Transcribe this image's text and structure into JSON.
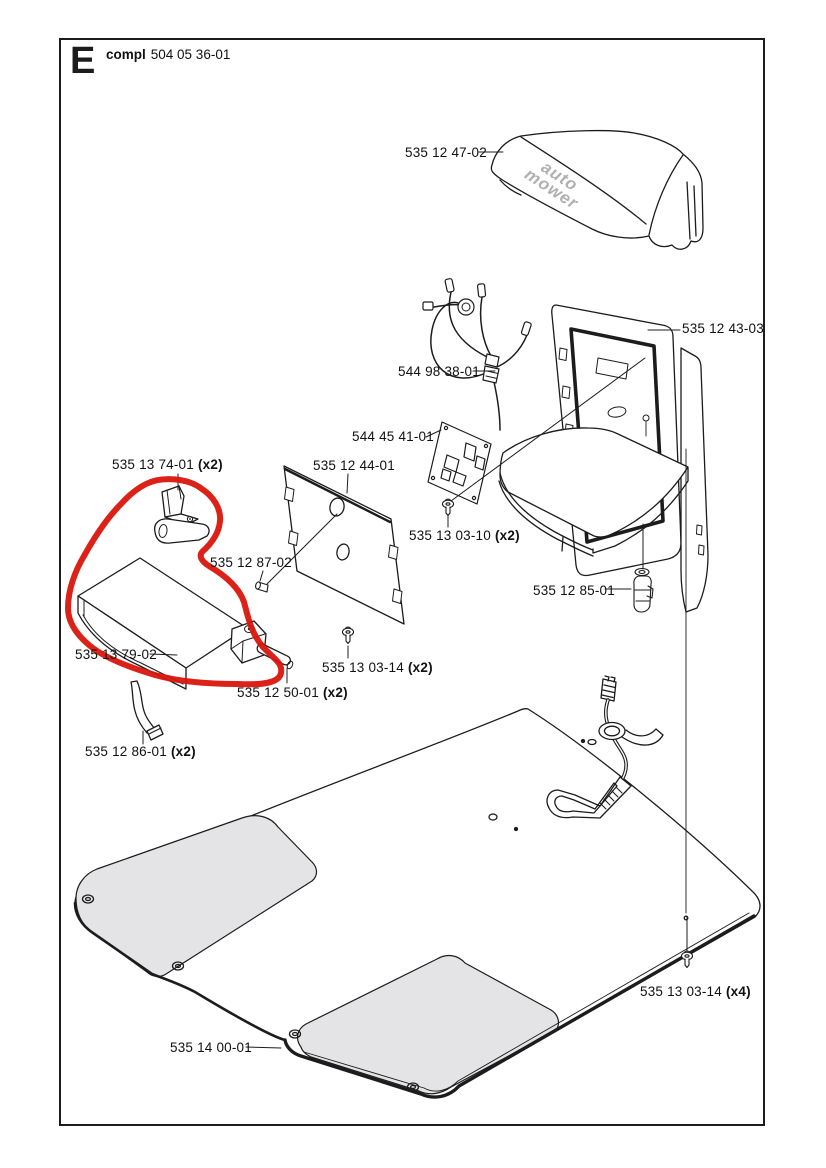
{
  "header": {
    "letter": "E",
    "compl_label": "compl",
    "assembly_number": "504 05 36-01"
  },
  "logo": {
    "line1": "auto",
    "line2": "mower"
  },
  "colors": {
    "line": "#1c1c1c",
    "shade_gray": "#e4e4e6",
    "logo_gray": "#b0b0b0",
    "annotation_red": "#d9150c"
  },
  "annotation": {
    "type": "freehand-circle",
    "color": "#d9150c"
  },
  "parts": [
    {
      "number": "535 12 47-02",
      "qty": ""
    },
    {
      "number": "535 12 43-03",
      "qty": ""
    },
    {
      "number": "544 98 38-01",
      "qty": ""
    },
    {
      "number": "544 45 41-01",
      "qty": ""
    },
    {
      "number": "535 12 44-01",
      "qty": ""
    },
    {
      "number": "535 13 74-01",
      "qty": "(x2)"
    },
    {
      "number": "535 13 03-10",
      "qty": "(x2)"
    },
    {
      "number": "535 12 87-02",
      "qty": ""
    },
    {
      "number": "535 12 85-01",
      "qty": ""
    },
    {
      "number": "535 13 79-02",
      "qty": ""
    },
    {
      "number": "535 13 03-14",
      "qty": "(x2)"
    },
    {
      "number": "535 12 50-01",
      "qty": "(x2)"
    },
    {
      "number": "535 12 86-01",
      "qty": "(x2)"
    },
    {
      "number": "535 13 03-14",
      "qty": "(x4)"
    },
    {
      "number": "535 14 00-01",
      "qty": ""
    }
  ]
}
